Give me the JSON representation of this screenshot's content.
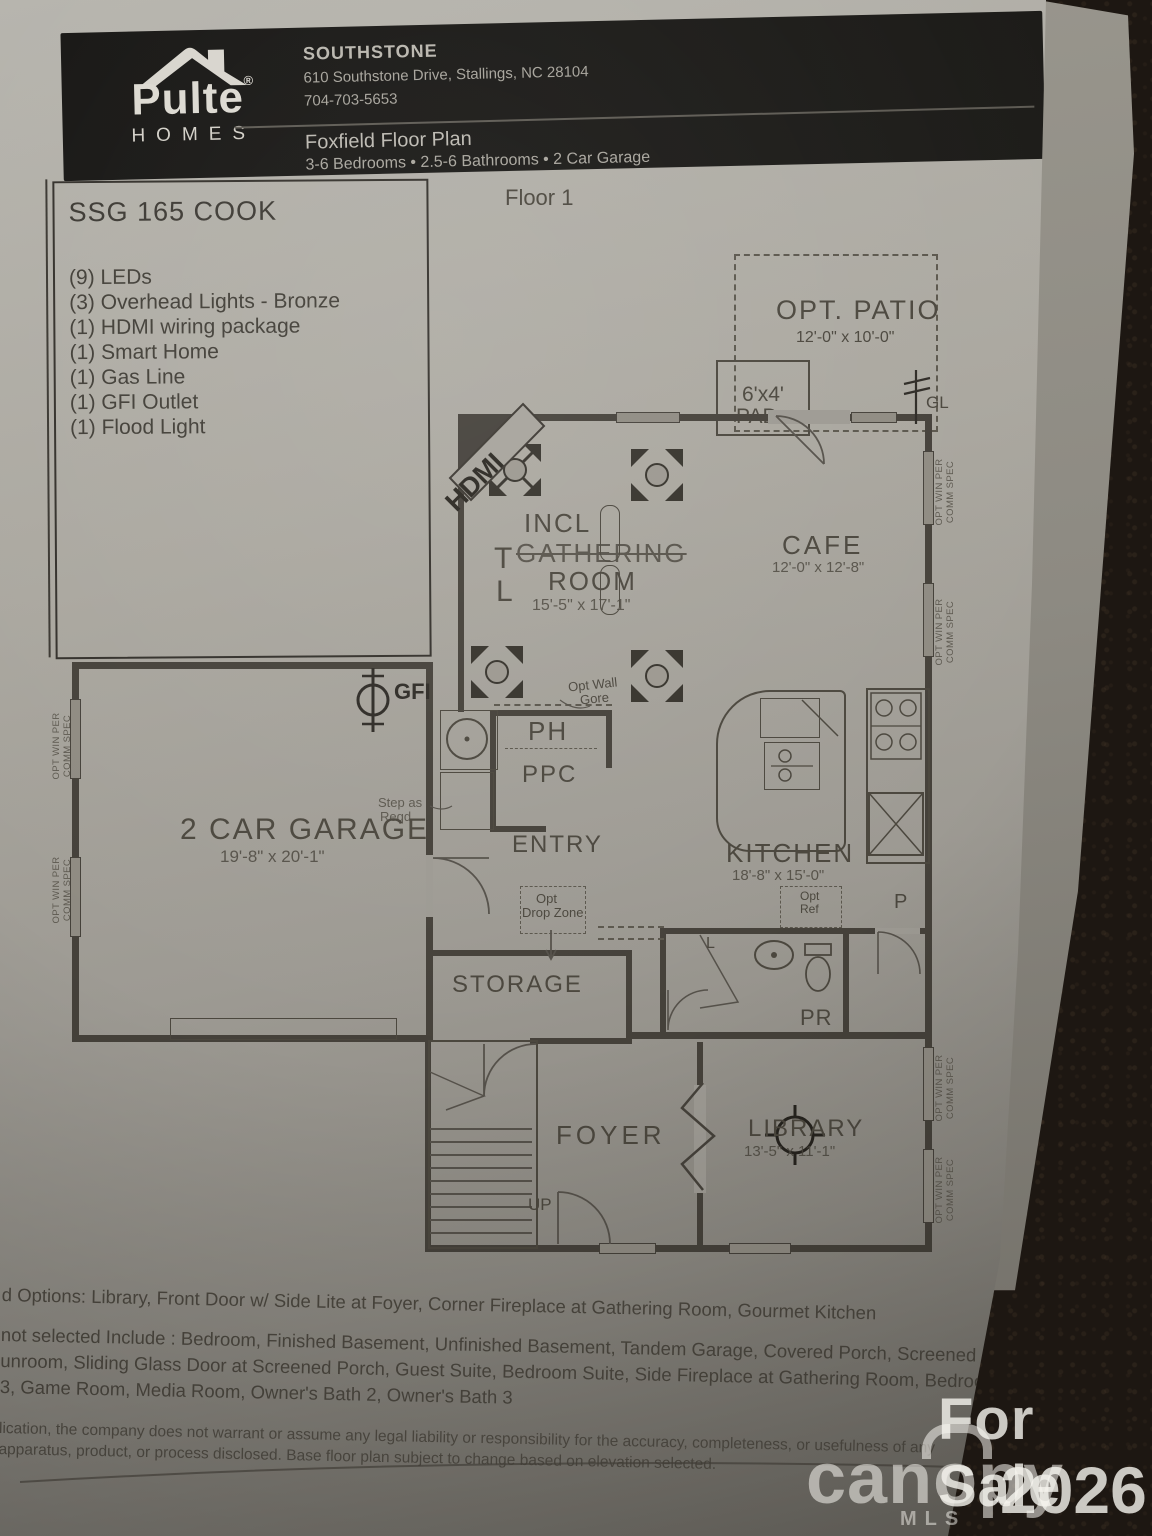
{
  "header": {
    "brand": {
      "name": "Pulte",
      "reg": "®",
      "sub": "HOMES"
    },
    "community": {
      "name": "SOUTHSTONE",
      "address": "610 Southstone Drive, Stallings, NC 28104",
      "phone": "704-703-5653"
    },
    "plan_name": "Foxfield Floor Plan",
    "plan_specs": "3-6 Bedrooms • 2.5-6 Bathrooms • 2 Car Garage"
  },
  "spec_box": {
    "title": "SSG 165 COOK",
    "items": [
      "(9) LEDs",
      "(3) Overhead Lights - Bronze",
      "(1) HDMI wiring package",
      "(1) Smart Home",
      "(1) Gas Line",
      "(1) GFI Outlet",
      "(1) Flood Light"
    ]
  },
  "floor_label": "Floor 1",
  "plan": {
    "patio": {
      "label": "OPT. PATIO",
      "dims": "12'-0\" x 10'-0\""
    },
    "pad": {
      "line1": "6'x4'",
      "line2": "PAD"
    },
    "gl": "GL",
    "hdmi": "HDMI",
    "gathering": {
      "incl": "INCL",
      "name": "GATHERING",
      "name2": "ROOM",
      "dims": "15'-5\" x 17'-1\""
    },
    "t": "T",
    "l": "L",
    "cafe": {
      "label": "CAFE",
      "dims": "12'-0\" x 12'-8\""
    },
    "kitchen": {
      "label": "KITCHEN",
      "dims": "18'-8\" x 15'-0\""
    },
    "ph": "PH",
    "ppc": "PPC",
    "entry": "ENTRY",
    "storage": "STORAGE",
    "drop_zone": {
      "line1": "Opt",
      "line2": "Drop Zone"
    },
    "opt_wall": {
      "line1": "Opt Wall",
      "line2": "Gore"
    },
    "opt_ref": {
      "line1": "Opt",
      "line2": "Ref"
    },
    "pr": "PR",
    "pantry": "P",
    "linen": "L",
    "up": "UP",
    "garage": {
      "label": "2 CAR GARAGE",
      "dims": "19'-8\" x 20'-1\""
    },
    "gfi": "GFI",
    "step": {
      "line1": "Step as",
      "line2": "Reqd"
    },
    "foyer": "FOYER",
    "library": {
      "label": "LIBRARY",
      "dims": "13'-5\" x 11'-1\""
    },
    "win_label": {
      "line1": "OPT WIN PER",
      "line2": "COMM SPEC"
    }
  },
  "footer": {
    "options_line": "d Options: Library, Front Door w/ Side Lite at Foyer, Corner Fireplace at Gathering Room, Gourmet Kitchen",
    "not_selected_lines": [
      "not selected Include : Bedroom, Finished Basement, Unfinished Basement, Tandem Garage, Covered Porch, Screened",
      "unroom, Sliding Glass Door at Screened Porch, Guest Suite, Bedroom Suite, Side Fireplace at Gathering Room, Bedroom 5",
      "3, Game Room, Media Room, Owner's Bath 2, Owner's Bath 3"
    ],
    "disclaimer_lines": [
      "lication, the company does not warrant or assume any legal liability or responsibility for the accuracy, completeness, or usefulness of any",
      "apparatus, product, or process disclosed. Base floor plan subject to change based on elevation selected."
    ]
  },
  "watermark": {
    "for_sale": "For Sale",
    "brand": "canopy",
    "mls": "MLS",
    "year": "2026"
  },
  "colors": {
    "paper": "#a7a49c",
    "ink": "#46423a",
    "header_bg": "#171615",
    "carpet": "#1e1813",
    "watermark": "#e8e6e0"
  }
}
